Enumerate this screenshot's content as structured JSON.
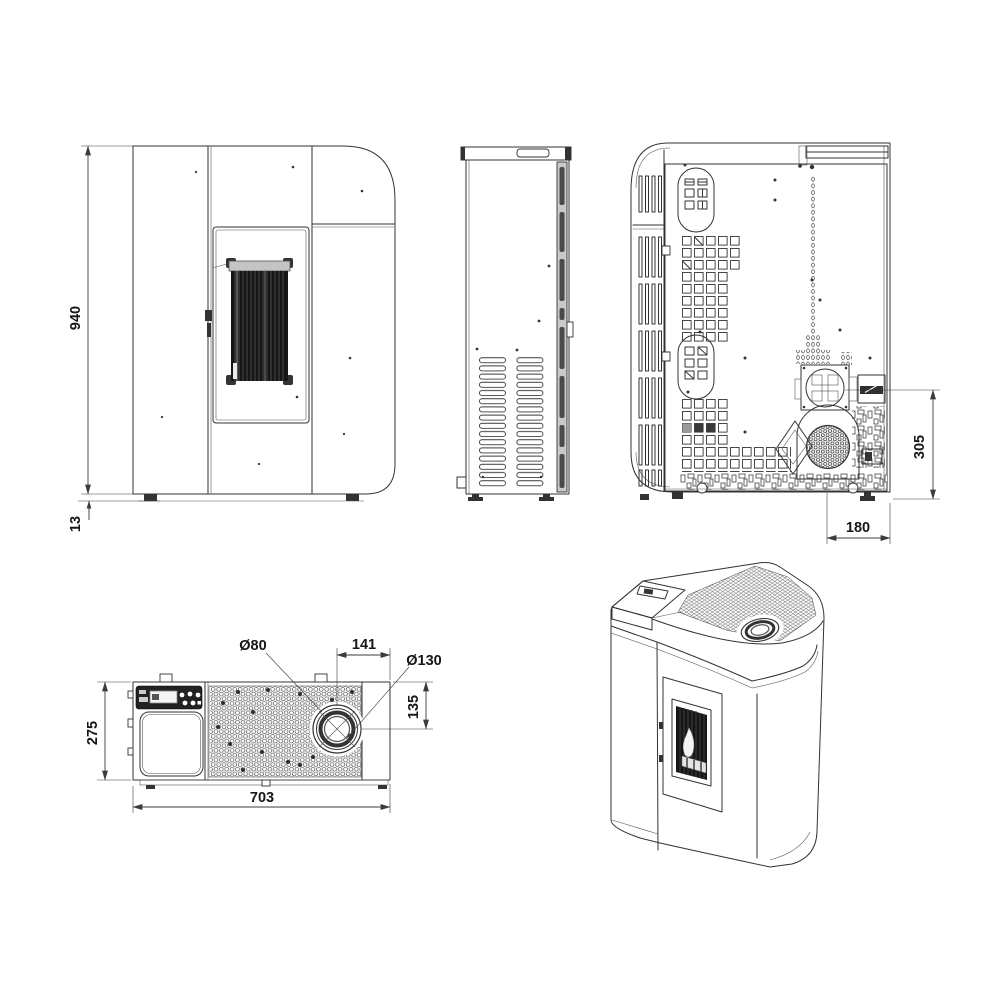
{
  "sheet": {
    "background": "#ffffff",
    "line_color": "#333333"
  },
  "views": {
    "front": "front-view",
    "side": "side-view",
    "back": "back-view",
    "top": "top-view",
    "persp": "perspective-view"
  },
  "dimensions": {
    "front_overall_height": "940",
    "front_foot_height": "13",
    "back_flue_height": "305",
    "back_flue_offset": "180",
    "top_smoke_outlet_diameter": "Ø80",
    "top_flue_offset_right": "141",
    "top_collar_diameter": "Ø130",
    "top_flue_offset_front": "135",
    "top_depth": "275",
    "top_overall_width": "703"
  }
}
